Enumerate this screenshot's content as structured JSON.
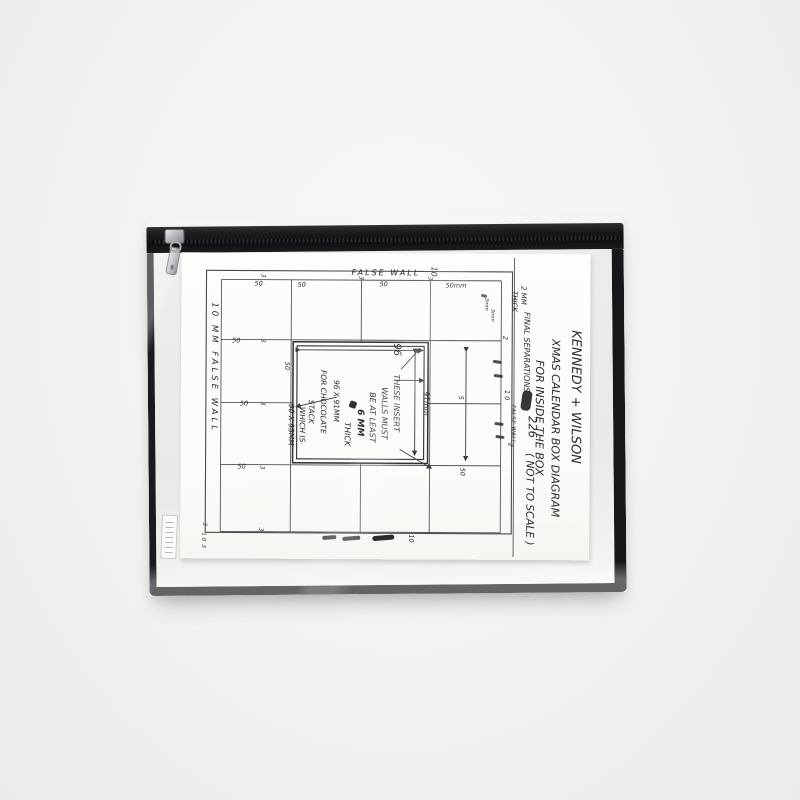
{
  "photo_colors": {
    "backdrop": "#f2f2f0",
    "pouch_trim": "#17171a",
    "vinyl": "#ececea",
    "paper": "#fcfcfa",
    "ink": "#2b2b2f",
    "zipper_metal": "#c9c9cd"
  },
  "diagram": {
    "top_label": "FALSE WALL",
    "top_right_number": "10",
    "col_labels": [
      "50",
      "50",
      "50",
      "50mm"
    ],
    "left_label": "10 MM FALSE WALL",
    "row_labels": [
      "50",
      "50",
      "50",
      "50"
    ],
    "sep_mark": "3",
    "bottom_left": [
      "3",
      "1 0",
      "3"
    ],
    "right_col": {
      "top": "2",
      "mid": "1 0",
      "label": "FALSE WALL",
      "bottom": "2",
      "cell5": "5",
      "cell50": "50"
    },
    "corner_note": "3mm",
    "bottom_number": "10",
    "insert": {
      "width_label": "96",
      "height_label": "91mm",
      "note": [
        "THESE INSERT",
        "WALLS MUST",
        "BE AT LEAST",
        "6 MM",
        "THICK"
      ]
    },
    "choc": [
      "96 X 91MM",
      "FOR CHOCOLATE",
      "STACK",
      "WHICH IS",
      "90 X 95MM"
    ],
    "margin": {
      "small": [
        "2 MM",
        "THICK",
        "FINAL SEPARATIONS"
      ],
      "title": [
        "KENNEDY + WILSON",
        "XMAS CALENDAR BOX DIAGRAM",
        "FOR INSIDE THE BOX"
      ],
      "number": "226",
      "scale_note": "( NOT TO SCALE )"
    }
  }
}
